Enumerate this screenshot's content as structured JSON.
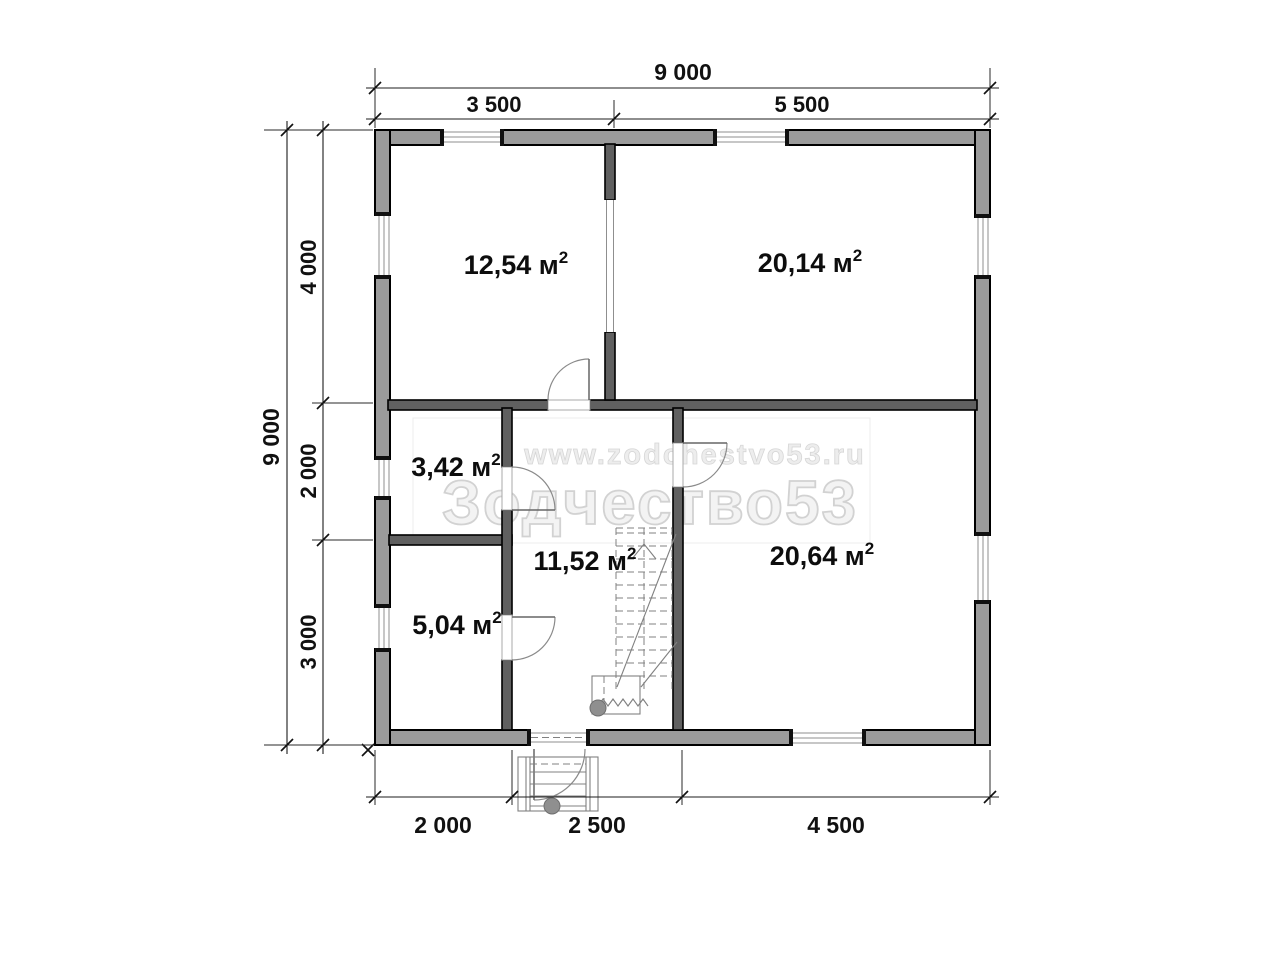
{
  "plan": {
    "watermark": {
      "url": "www.zodchestvo53.ru",
      "brand": "Зодчество53"
    },
    "rooms": [
      {
        "id": "room-top-left",
        "label": "12,54 м",
        "sup": "2"
      },
      {
        "id": "room-top-right",
        "label": "20,14 м",
        "sup": "2"
      },
      {
        "id": "room-middle-left",
        "label": "3,42 м",
        "sup": "2"
      },
      {
        "id": "hallway",
        "label": "11,52 м",
        "sup": "2"
      },
      {
        "id": "room-bottom-right",
        "label": "20,64 м",
        "sup": "2"
      },
      {
        "id": "room-bottom-left",
        "label": "5,04 м",
        "sup": "2"
      }
    ],
    "dimensions": {
      "top_total": "9 000",
      "top_segments": [
        "3 500",
        "5 500"
      ],
      "left_total": "9 000",
      "left_segments": [
        "4 000",
        "2 000",
        "3 000"
      ],
      "bottom_segments": [
        "2 000",
        "2 500",
        "4 500"
      ]
    },
    "colors": {
      "exterior_wall": "#9b9b9b",
      "interior_wall": "#606060",
      "line": "#1c1c1c",
      "watermark": "#e9e9e9"
    }
  }
}
